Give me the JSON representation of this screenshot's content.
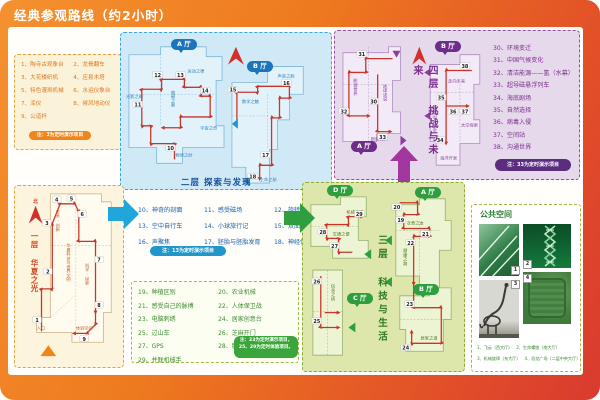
{
  "palette": {
    "frame_orange": "#EE7A1F",
    "frame_red": "#D93A2F",
    "route_red": "#C8362B",
    "floor1_accent": "#F08519",
    "floor2_accent": "#2196C9",
    "floor3_accent": "#3AA53A",
    "floor4_accent": "#8E3D9E"
  },
  "title": "经典参观路线（约2小时）",
  "north": "北",
  "floor1": {
    "title": "一层 华夏之光",
    "items": [
      "1、陶寺古观象台",
      "2、龙骨翻车",
      "3、大花楼织机",
      "4、应县木塔",
      "5、特色灌溉机械",
      "6、水运仪象台",
      "7、浑仪",
      "8、候风地动仪",
      "9、公道杯"
    ],
    "note": "注：3为定时演示项目",
    "zones": [
      "技术·创新",
      "华夏科技与世界文明",
      "科学·探索",
      "入口",
      "体验空间"
    ],
    "stops": [
      "1",
      "2",
      "3",
      "4",
      "5",
      "6",
      "7",
      "8",
      "9"
    ]
  },
  "floor2": {
    "title": "二层 探索与发现",
    "halls": [
      "A 厅",
      "B 厅"
    ],
    "items": [
      "10、神奇的剖面",
      "11、感受磁场",
      "12、旋转的金蛋",
      "13、空中自行车",
      "14、小球旅行记",
      "15、双曲隧道",
      "16、声聚焦",
      "17、胚胎与胚胎发育",
      "18、神经传导"
    ],
    "note": "注：13为定时演示项目",
    "zones": [
      "光影之绚",
      "电磁之奥",
      "运动之律",
      "宇宙之奇",
      "物质之妙",
      "数学之魅",
      "声音之韵",
      "生命之秘"
    ],
    "stops": [
      "10",
      "11",
      "12",
      "13",
      "14",
      "15",
      "16",
      "17",
      "18"
    ]
  },
  "floor3": {
    "title": "三层 科技与生活",
    "halls": [
      "D 厅",
      "A 厅",
      "B 厅",
      "C 厅"
    ],
    "items": [
      "19、种植区别",
      "20、农业机械",
      "21、感受自己的脉搏",
      "22、人体保卫战",
      "23、电脑刺绣",
      "24、居家创意台",
      "25、过山车",
      "26、芝麻开门",
      "27、GPS",
      "28、糖果传送器",
      "29、并联机械手"
    ],
    "note": "注：23为定时演示项目，25、29为定时体验项目。",
    "zones": [
      "交通之便",
      "机械之巧",
      "衣食之本",
      "健康之路",
      "居家之道",
      "信息之桥"
    ],
    "stops": [
      "19",
      "20",
      "21",
      "22",
      "23",
      "24",
      "25",
      "26",
      "27",
      "28",
      "29"
    ]
  },
  "floor4": {
    "title": "四层 挑战与未来",
    "halls": [
      "A 厅",
      "B 厅"
    ],
    "items": [
      "30、环境变迁",
      "31、中国气候变化",
      "32、清洁能源——氢（水幕）",
      "33、超导磁悬浮列车",
      "34、海底剧场",
      "35、自然选择",
      "36、病毒入侵",
      "37、空间站",
      "38、沟通世界"
    ],
    "note": "注：33为定时演示项目",
    "zones": [
      "能源世界",
      "地球述说",
      "新型材料",
      "走向未来",
      "基因·生命",
      "太空探索",
      "海洋开发"
    ],
    "stops": [
      "30",
      "31",
      "32",
      "33",
      "34",
      "35",
      "36",
      "37",
      "38"
    ]
  },
  "public_space": {
    "title": "公共空间",
    "captions": [
      "1、飞云（西大厅）",
      "2、生命螺旋（南大厅）",
      "3、机械旋律（东大厅）",
      "4、恐龙广场（二层中央大厅）"
    ],
    "photo_tags": [
      "1",
      "2",
      "3",
      "4"
    ]
  }
}
